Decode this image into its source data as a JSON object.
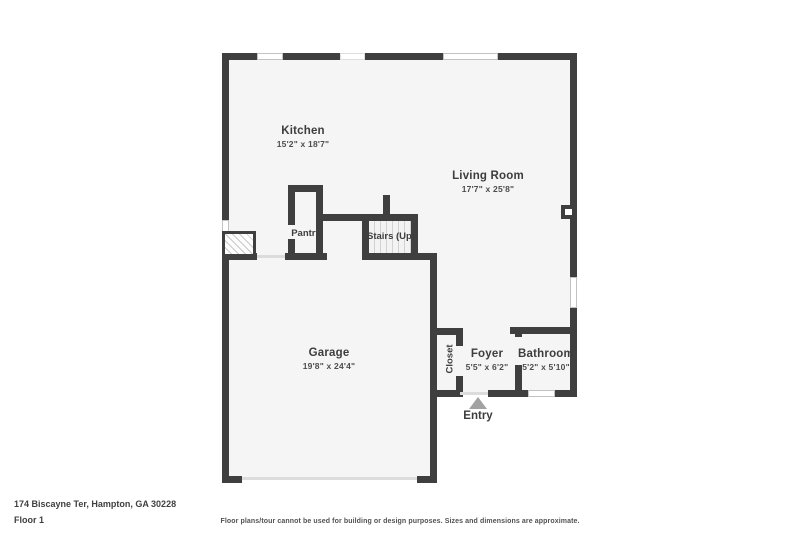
{
  "title_block": {
    "address": "174 Biscayne Ter, Hampton, GA 30228",
    "floor": "Floor 1",
    "disclaimer": "Floor plans/tour cannot be used for building or design purposes. Sizes and dimensions are approximate."
  },
  "rooms": {
    "kitchen": {
      "name": "Kitchen",
      "dims": "15'2\" x 18'7\""
    },
    "living_room": {
      "name": "Living Room",
      "dims": "17'7\" x 25'8\""
    },
    "pantry": {
      "name": "Pantry"
    },
    "stairs": {
      "name": "Stairs (Up)"
    },
    "garage": {
      "name": "Garage",
      "dims": "19'8\" x 24'4\""
    },
    "closet": {
      "name": "Closet"
    },
    "foyer": {
      "name": "Foyer",
      "dims": "5'5\" x 6'2\""
    },
    "bathroom": {
      "name": "Bathroom",
      "dims": "5'2\" x 5'10\""
    }
  },
  "markers": {
    "entry": "Entry"
  },
  "colors": {
    "wall": "#3f3f3f",
    "floor_fill": "#f6f5f5",
    "entry_arrow": "#a2a2a2",
    "window_outline": "#c2c2c2"
  }
}
